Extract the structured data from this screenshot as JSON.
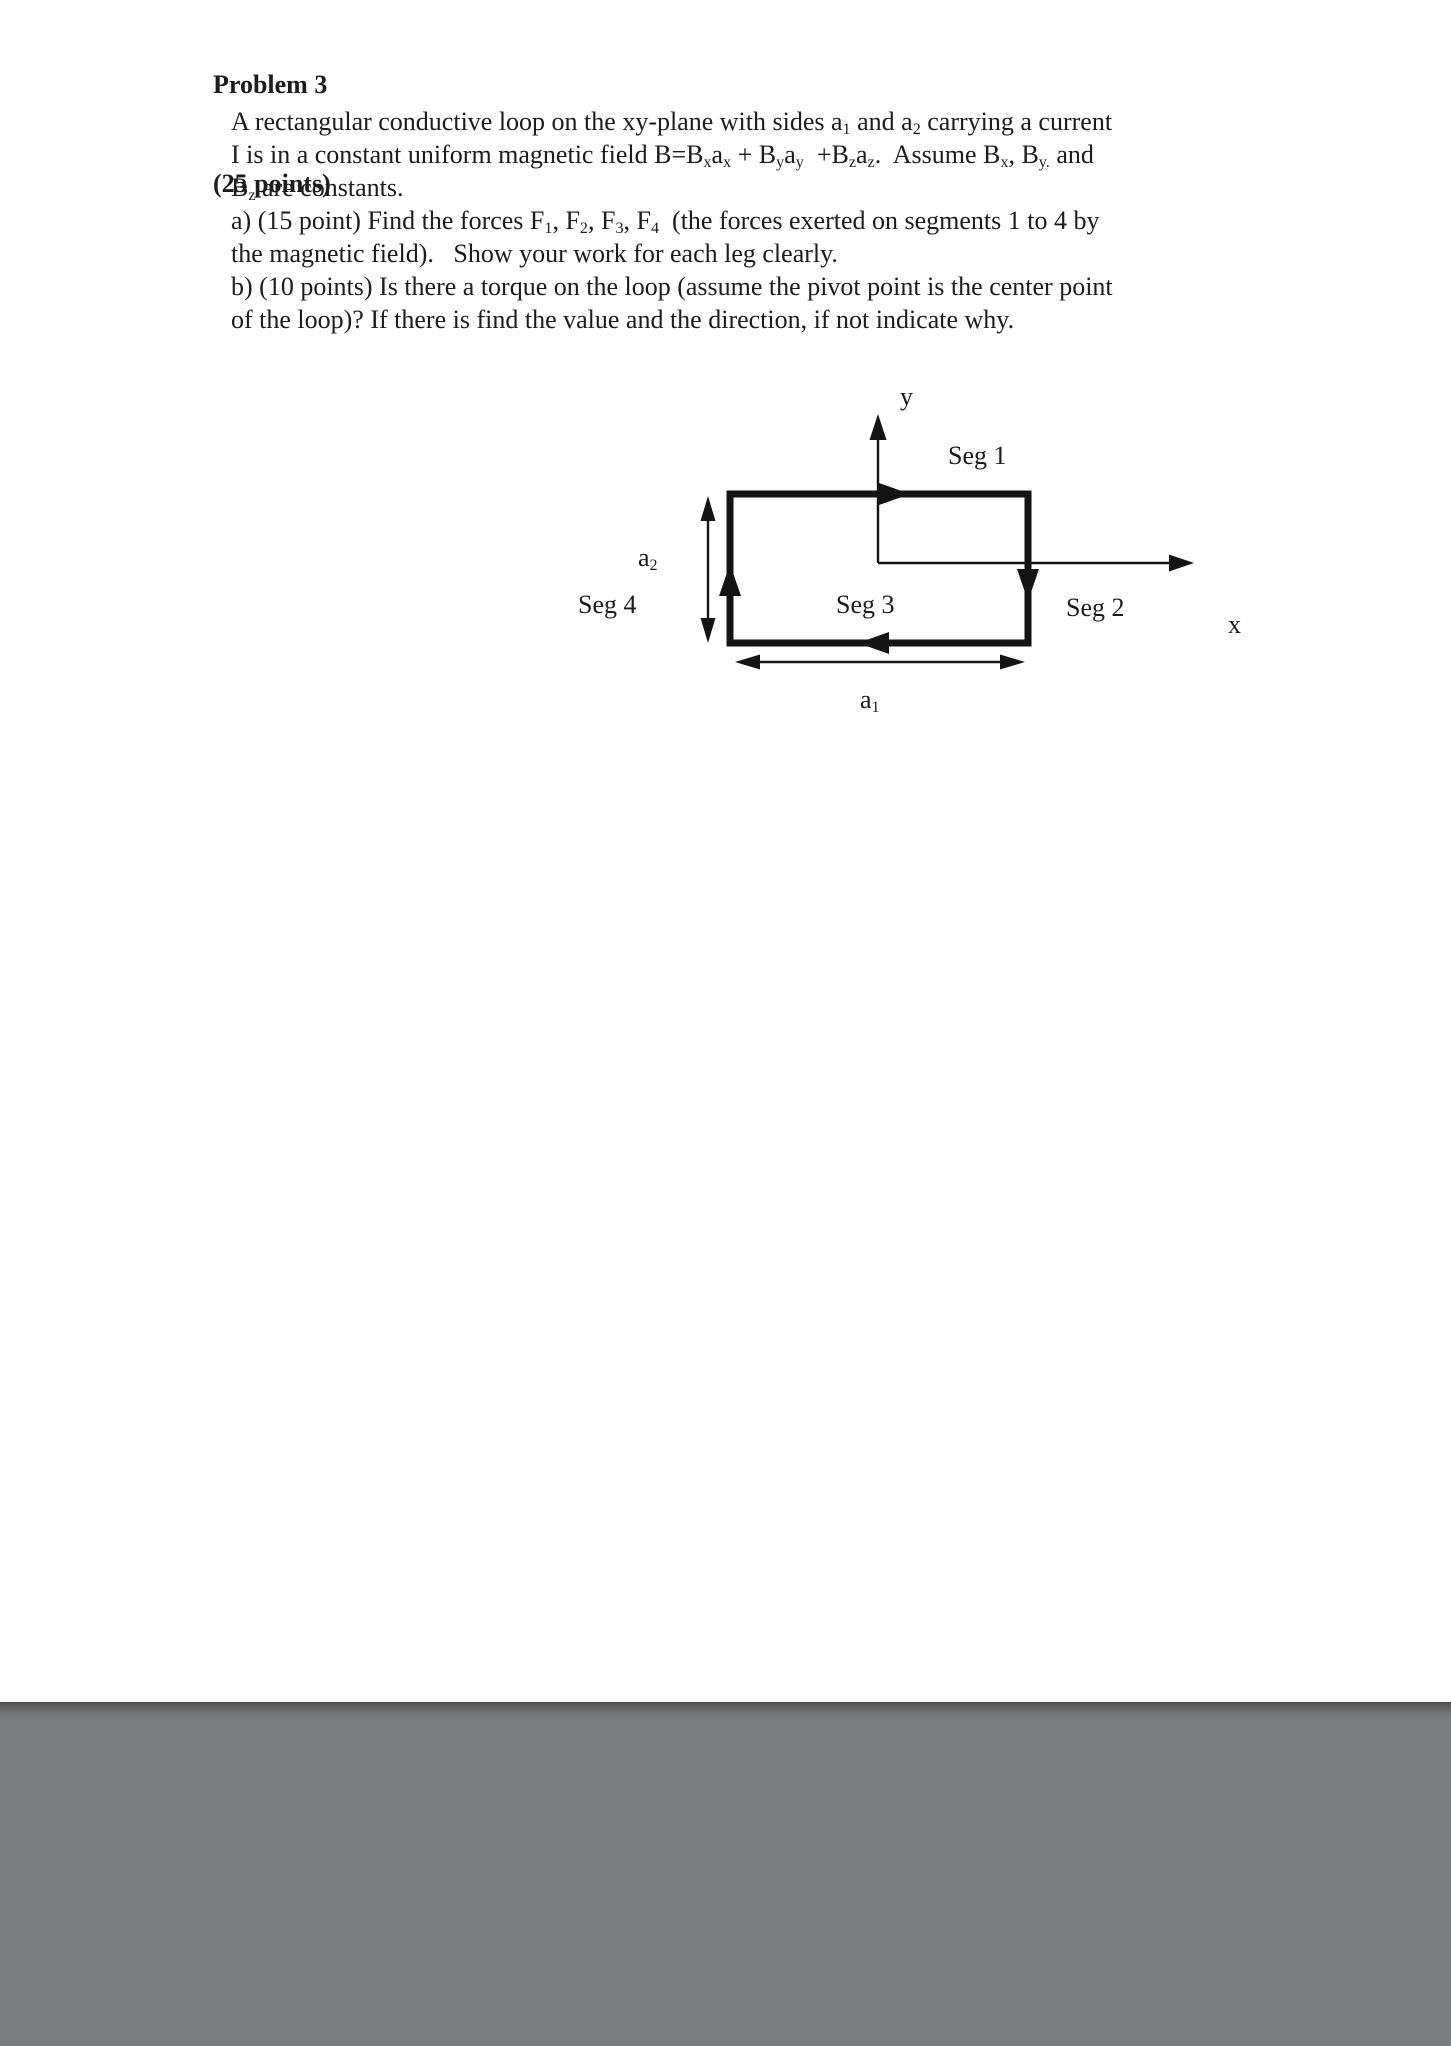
{
  "colors": {
    "ink": "#1c1c1c",
    "footer_gray": "#7b7d81"
  },
  "header": {
    "problem": "Problem 3",
    "points": "(25 points)"
  },
  "problem": {
    "lines": [
      [
        {
          "t": "A rectangular conductive loop on the xy-plane with sides a"
        },
        {
          "sub": "1"
        },
        {
          "t": " and a"
        },
        {
          "sub": "2"
        },
        {
          "t": " carrying a current"
        }
      ],
      [
        {
          "t": "I is in a constant uniform magnetic field B=B"
        },
        {
          "sub": "x"
        },
        {
          "t": "a"
        },
        {
          "sub": "x"
        },
        {
          "t": " + B"
        },
        {
          "sub": "y"
        },
        {
          "t": "a"
        },
        {
          "sub": "y"
        },
        {
          "t": "  +B"
        },
        {
          "sub": "z"
        },
        {
          "t": "a"
        },
        {
          "sub": "z"
        },
        {
          "t": ".  Assume B"
        },
        {
          "sub": "x"
        },
        {
          "t": ", B"
        },
        {
          "sub": "y."
        },
        {
          "t": " and"
        }
      ],
      [
        {
          "t": "B"
        },
        {
          "sub": "z"
        },
        {
          "t": " are constants."
        }
      ],
      [
        {
          "t": "a) (15 point) Find the forces F"
        },
        {
          "sub": "1"
        },
        {
          "t": ", F"
        },
        {
          "sub": "2"
        },
        {
          "t": ", F"
        },
        {
          "sub": "3"
        },
        {
          "t": ", F"
        },
        {
          "sub": "4"
        },
        {
          "t": "  (the forces exerted on segments 1 to 4 by"
        }
      ],
      [
        {
          "t": "the magnetic field).   Show your work for each leg clearly."
        }
      ],
      [
        {
          "t": "b) (10 points) Is there a torque on the loop (assume the pivot point is the center point"
        }
      ],
      [
        {
          "t": "of the loop)? If there is find the value and the direction, if not indicate why."
        }
      ]
    ]
  },
  "diagram": {
    "axis": {
      "x_label": "x",
      "y_label": "y"
    },
    "segments": {
      "seg1": "Seg 1",
      "seg2": "Seg 2",
      "seg3": "Seg 3",
      "seg4": "Seg 4"
    },
    "dimensions": {
      "a1": [
        {
          "t": "a"
        },
        {
          "sub": "1"
        }
      ],
      "a2": [
        {
          "t": "a"
        },
        {
          "sub": "2"
        }
      ]
    }
  }
}
